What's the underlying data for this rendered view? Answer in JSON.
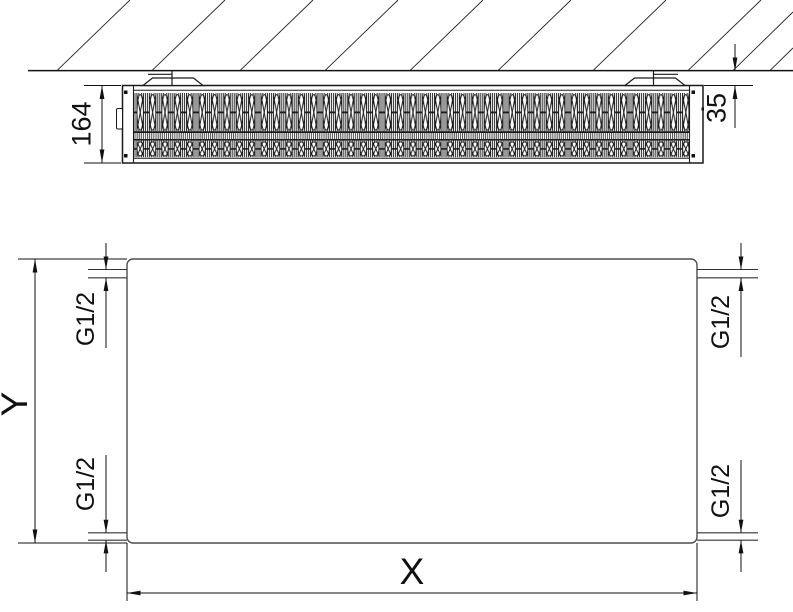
{
  "top_view": {
    "depth_label": "164",
    "wall_distance_label": "35"
  },
  "front_view": {
    "height_label": "Y",
    "width_label": "X",
    "connection_top_left": "G1/2",
    "connection_top_right": "G1/2",
    "connection_bottom_left": "G1/2",
    "connection_bottom_right": "G1/2"
  },
  "colors": {
    "line": "#1a1a1a",
    "panel_outline": "#4d4d4d",
    "background": "#ffffff"
  }
}
